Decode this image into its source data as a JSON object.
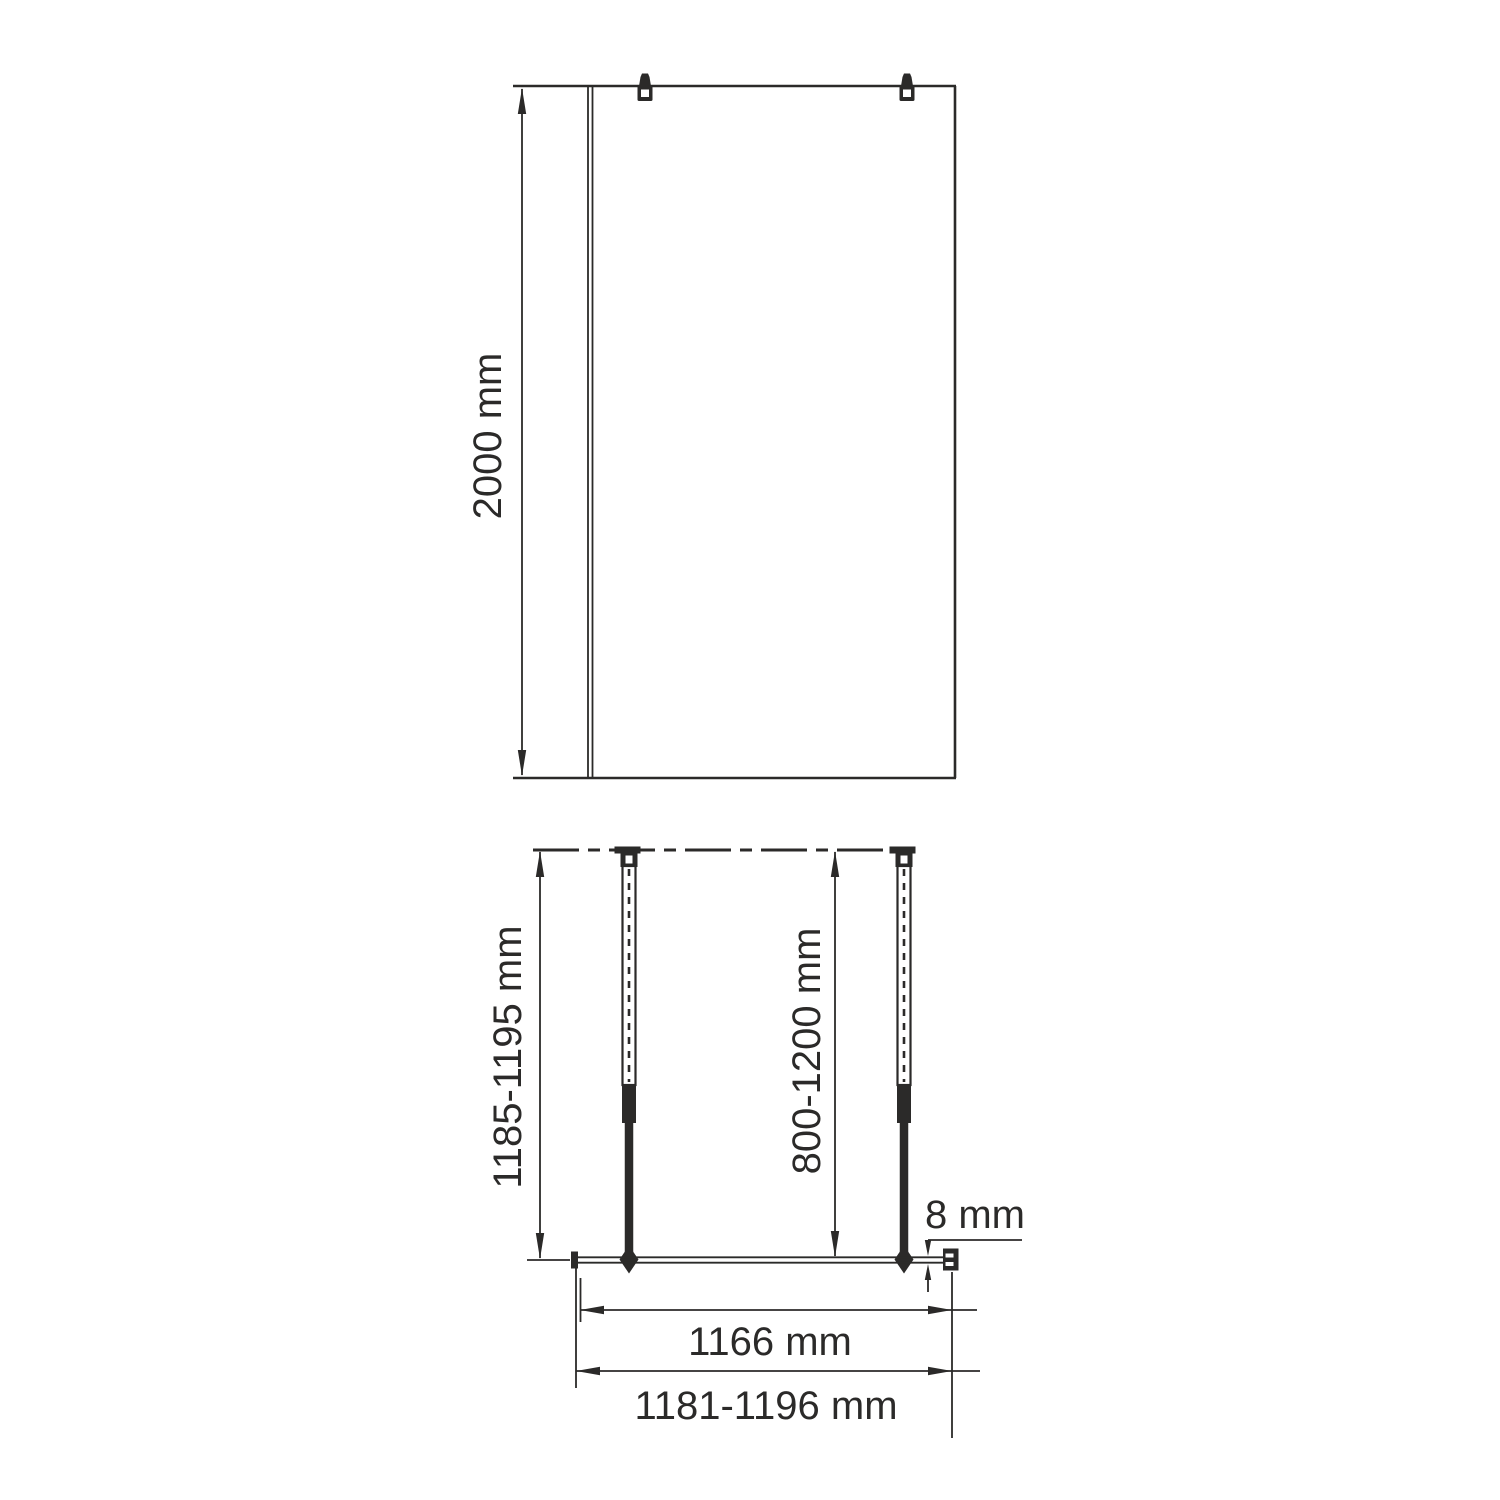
{
  "front_view": {
    "height_label": "2000 mm"
  },
  "plan_view": {
    "installation_depth_label": "1185-1195 mm",
    "support_bar_range_label": "800-1200 mm",
    "glass_thickness_label": "8 mm",
    "glass_width_label": "1166 mm",
    "overall_width_label": "1181-1196 mm"
  },
  "colors": {
    "line": "#2b2a29",
    "background": "#ffffff"
  }
}
